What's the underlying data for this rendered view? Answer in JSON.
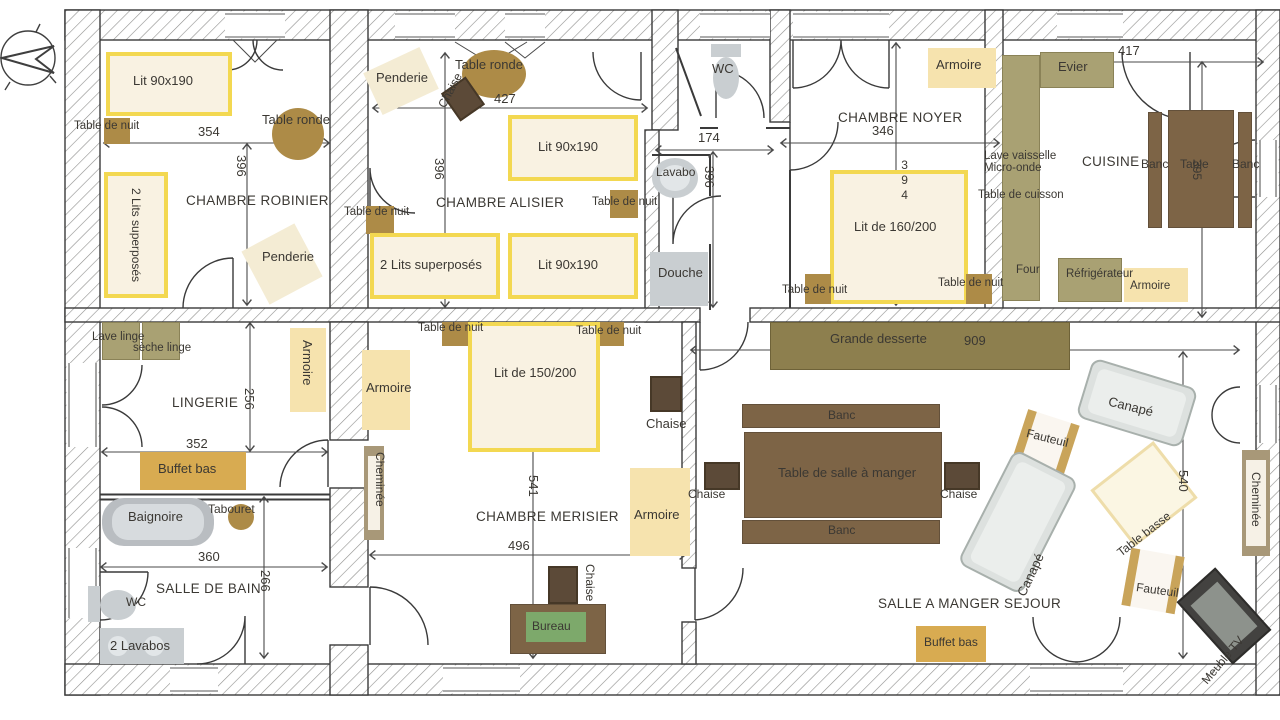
{
  "plan_title": "Plan de maison - rez de chaussee",
  "rooms": {
    "robinier": {
      "name": "CHAMBRE ROBINIER",
      "dim_w": "354",
      "dim_h": "396",
      "furn": {
        "bed": "Lit 90x190",
        "nightstand": "Table de nuit",
        "round_table": "Table ronde",
        "bunk": "2 Lits superposés",
        "wardrobe": "Penderie"
      }
    },
    "alisier": {
      "name": "CHAMBRE ALISIER",
      "dim_w": "427",
      "dim_h": "396",
      "furn": {
        "wardrobe": "Penderie",
        "round_table": "Table ronde",
        "chair": "Chaise",
        "bed1": "Lit 90x190",
        "bed2": "Lit 90x190",
        "bunk": "2 Lits superposés",
        "nightstand_left": "Table de nuit",
        "nightstand_right": "Table de nuit"
      }
    },
    "wc": {
      "name": "WC"
    },
    "bath": {
      "dim_w": "174",
      "dim_h": "396",
      "furn": {
        "sink": "Lavabo",
        "shower": "Douche"
      }
    },
    "noyer": {
      "name": "CHAMBRE NOYER",
      "dim_w": "346",
      "dim_h": "394",
      "furn": {
        "wardrobe": "Armoire",
        "bed": "Lit de 160/200",
        "nightstand_left": "Table de nuit",
        "nightstand_right": "Table de nuit"
      }
    },
    "cuisine": {
      "name": "CUISINE",
      "dim_w": "417",
      "dim_h": "395",
      "furn": {
        "sink": "Evier",
        "dishwasher": "Lave vaisselle",
        "microwave": "Micro-onde",
        "cooktop": "Table de cuisson",
        "oven": "Four",
        "fridge": "Réfrigérateur",
        "wardrobe": "Armoire",
        "bench_left": "Banc",
        "table": "Table",
        "bench_right": "Banc"
      }
    },
    "lingerie": {
      "name": "LINGERIE",
      "dim_w": "352",
      "dim_h": "256",
      "furn": {
        "washer": "Lave linge",
        "dryer": "sèche linge",
        "sideboard": "Buffet bas",
        "wardrobe": "Armoire"
      }
    },
    "bain": {
      "name": "SALLE DE BAIN",
      "dim_w": "360",
      "dim_h": "266",
      "furn": {
        "bathtub": "Baignoire",
        "stool": "Tabouret",
        "wc": "WC",
        "sinks": "2 Lavabos"
      }
    },
    "merisier": {
      "name": "CHAMBRE MERISIER",
      "dim_w": "496",
      "dim_h": "541",
      "furn": {
        "bed": "Lit de 150/200",
        "nightstand_left": "Table de nuit",
        "nightstand_right": "Table de nuit",
        "wardrobe_left": "Armoire",
        "wardrobe_right": "Armoire",
        "fireplace": "Cheminée",
        "chair_right": "Chaise",
        "chair_desk": "Chaise",
        "desk": "Bureau"
      }
    },
    "sejour": {
      "name": "SALLE A MANGER SEJOUR",
      "dim_w": "909",
      "dim_h": "540",
      "furn": {
        "sideboard": "Grande desserte",
        "bench_top": "Banc",
        "bench_bottom": "Banc",
        "table": "Table de salle à manger",
        "chair_left": "Chaise",
        "chair_right": "Chaise",
        "sofa_top": "Canapé",
        "sofa_left": "Canapé",
        "armchair_top": "Fauteuil",
        "armchair_bottom": "Fauteuil",
        "coffee_table": "Table basse",
        "fireplace": "Cheminée",
        "tv_unit": "Meuble TV",
        "buffet": "Buffet bas"
      }
    }
  },
  "colors": {
    "bed_border": "#f3d851",
    "bed_fill": "#f9f2e2",
    "wood": "#ad8b47",
    "dark_wood": "#5c4a38",
    "wardrobe_tan": "#f6e3ae",
    "counter_olive": "#a9a173",
    "dining_brown": "#7d6446",
    "buffet_gold": "#d8ab51",
    "fixture_gray": "#c9ced1",
    "desk_green": "#7da96b"
  }
}
